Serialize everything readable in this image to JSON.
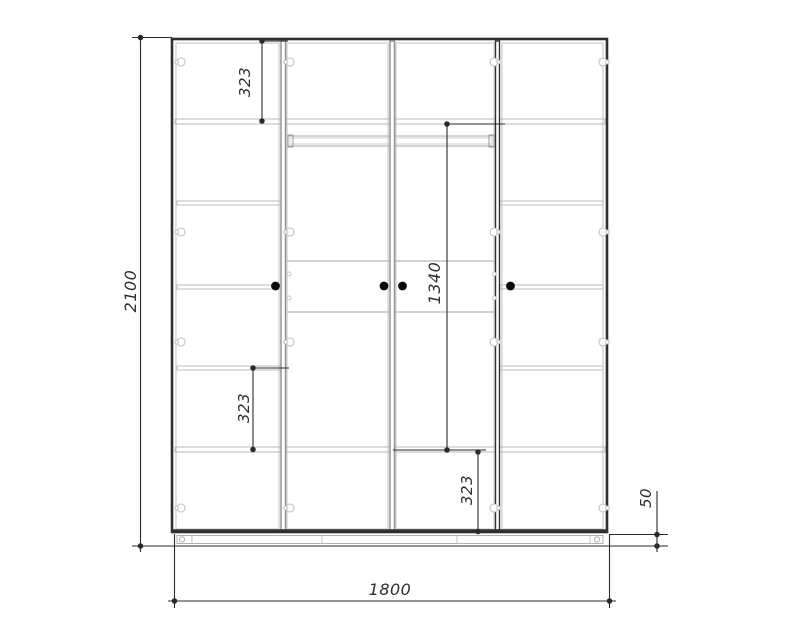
{
  "drawing": {
    "kind": "wardrobe-front-elevation-technical-drawing",
    "dimensions": {
      "overall_height": "2100",
      "overall_width": "1800",
      "plinth_height": "50",
      "top_section_height": "323",
      "left_shelf_spacing": "323",
      "hanging_section_height": "1340",
      "bottom_section_height": "323"
    },
    "icons": {
      "hinge": "circle-with-notch",
      "door_handle": "filled-dot",
      "shelf_pin": "small-circle",
      "dimension_marker": "dot"
    },
    "colors": {
      "background": "#ffffff",
      "carcass_line": "#2f2f2f",
      "divider_line": "#8f8f8f",
      "shelf_line": "#b8b8b8",
      "door_outline": "#cccccc",
      "dimension_line": "#2a2a2a",
      "handle": "#0a0a0a"
    }
  }
}
